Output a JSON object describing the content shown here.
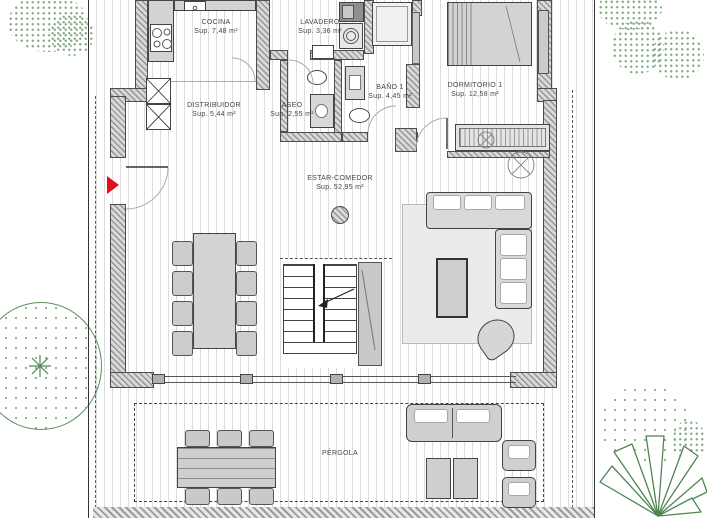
{
  "plan": {
    "rooms": [
      {
        "name": "COCINA",
        "area": "Sup. 7,48 m²"
      },
      {
        "name": "LAVADERO",
        "area": "Sup. 3,36 m²"
      },
      {
        "name": "DISTRIBUIDOR",
        "area": "Sup. 5,44 m²"
      },
      {
        "name": "ASEO",
        "area": "Sup. 2,55 m²"
      },
      {
        "name": "BAÑO 1",
        "area": "Sup. 4,45 m²"
      },
      {
        "name": "DORMITORIO 1",
        "area": "Sup. 12,58 m²"
      },
      {
        "name": "ESTAR-COMEDOR",
        "area": "Sup. 52,95 m²"
      },
      {
        "name": "PÉRGOLA",
        "area": ""
      }
    ],
    "colors": {
      "entrance_arrow": "#e0111b",
      "vegetation": "#5d8f5f",
      "wall_hatch": "#969696",
      "floor_stripe": "#dcdcdc"
    }
  }
}
